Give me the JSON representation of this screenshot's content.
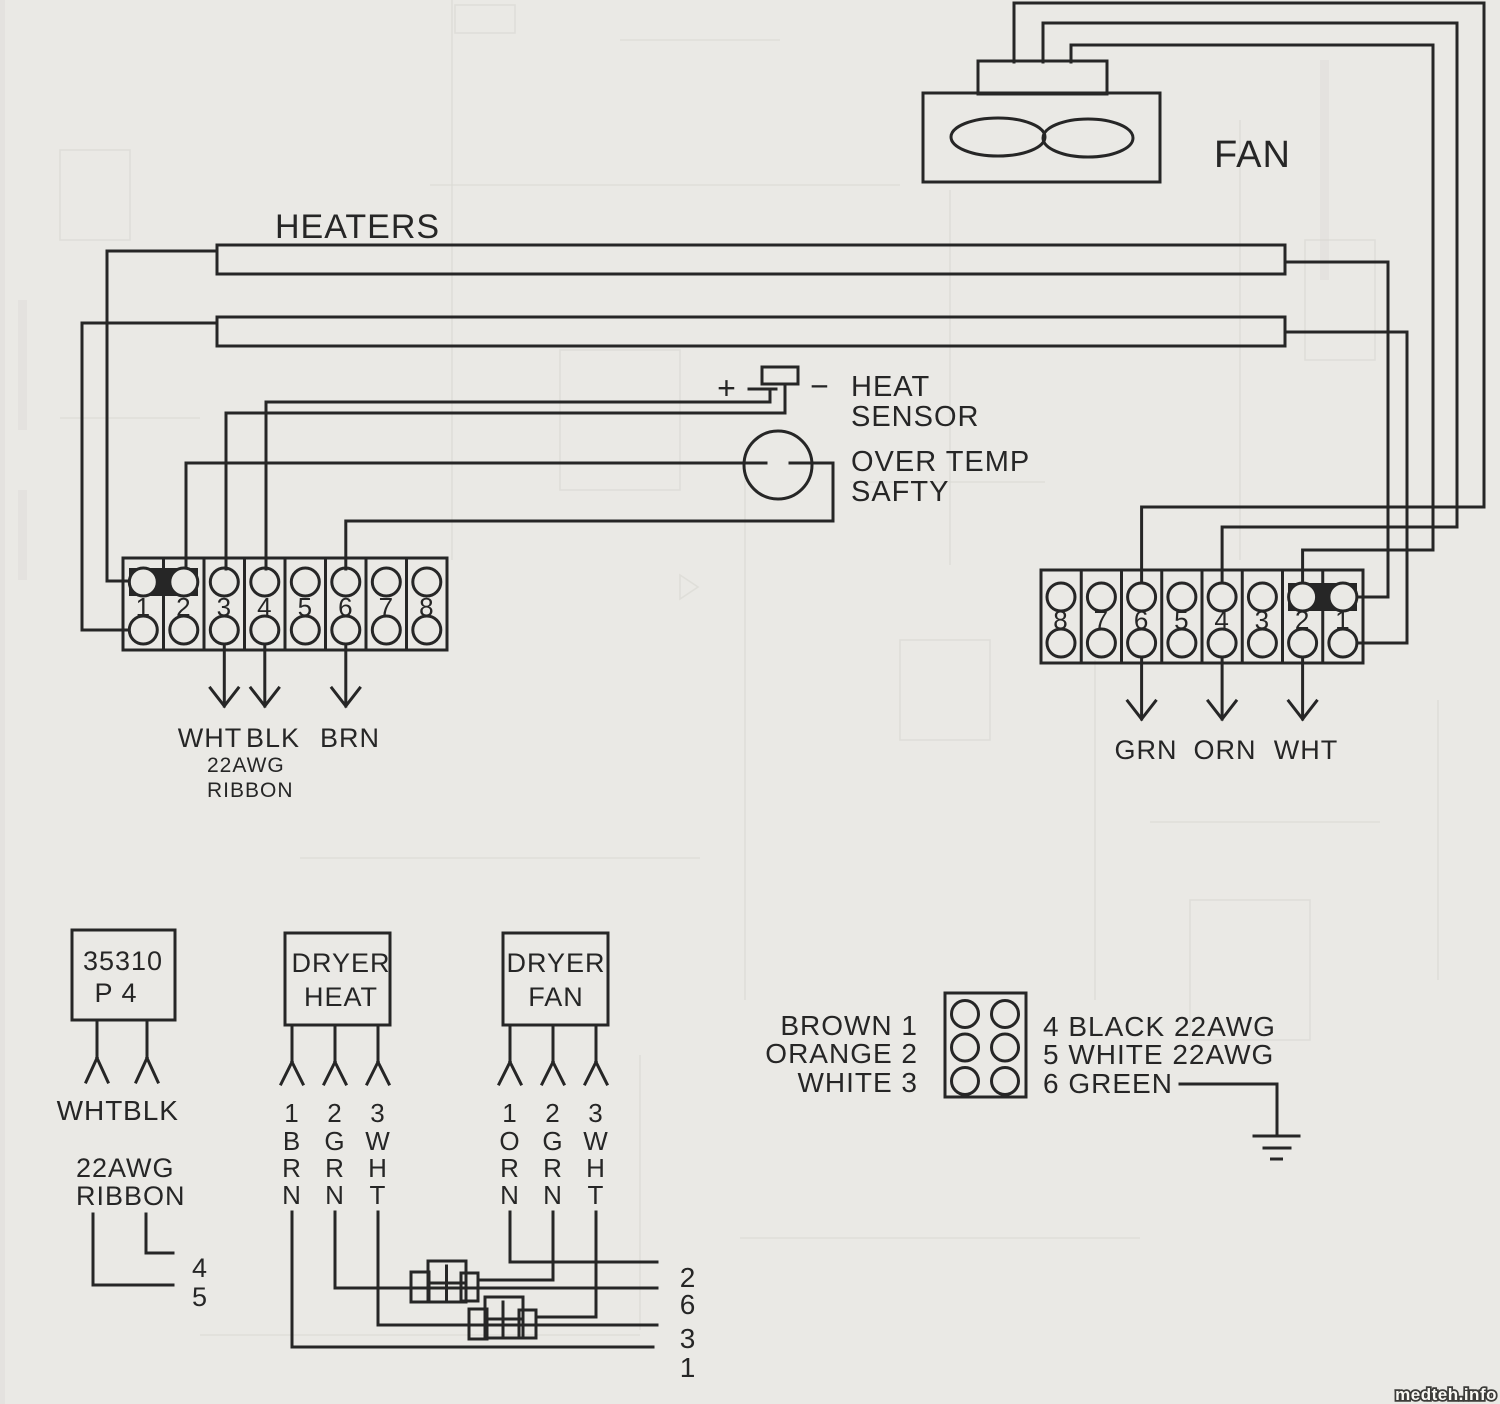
{
  "palette": {
    "paper": "#eae9e5",
    "ink": "#262626",
    "ghost_line": "#d9d8d3",
    "watermark_text": "#faf9f4",
    "watermark_outline": "#3c3c39"
  },
  "fan": {
    "label": "FAN"
  },
  "heaters": {
    "label": "HEATERS"
  },
  "heat_sensor": {
    "plus": "+",
    "minus": "−",
    "label": [
      "HEAT",
      "SENSOR"
    ]
  },
  "over_temp": {
    "label": [
      "OVER TEMP",
      "SAFTY"
    ]
  },
  "left_block": {
    "cells": [
      "1",
      "2",
      "3",
      "4",
      "5",
      "6",
      "7",
      "8"
    ],
    "wire_labels": [
      "WHT",
      "BLK",
      "BRN"
    ],
    "wire_note": [
      "22AWG",
      "RIBBON"
    ]
  },
  "right_block": {
    "cells": [
      "8",
      "7",
      "6",
      "5",
      "4",
      "3",
      "2",
      "1"
    ],
    "wire_labels": [
      "GRN",
      "ORN",
      "WHT"
    ]
  },
  "plug_35310": {
    "label": [
      "35310",
      "P 4"
    ],
    "lead_labels": [
      "WHT",
      "BLK"
    ],
    "note": [
      "22AWG",
      "RIBBON"
    ],
    "pin_numbers": [
      "4",
      "5"
    ]
  },
  "dryer_heat": {
    "label": [
      "DRYER",
      "HEAT"
    ],
    "leads": [
      [
        "1",
        "B",
        "R",
        "N"
      ],
      [
        "2",
        "G",
        "R",
        "N"
      ],
      [
        "3",
        "W",
        "H",
        "T"
      ]
    ]
  },
  "dryer_fan": {
    "label": [
      "DRYER",
      "FAN"
    ],
    "leads": [
      [
        "1",
        "O",
        "R",
        "N"
      ],
      [
        "2",
        "G",
        "R",
        "N"
      ],
      [
        "3",
        "W",
        "H",
        "T"
      ]
    ]
  },
  "bottom_pins": [
    "2",
    "6",
    "3",
    "1"
  ],
  "harness_connector": {
    "left_pins": [
      "BROWN 1",
      "ORANGE 2",
      "WHITE 3"
    ],
    "right_pins": [
      "4 BLACK 22AWG",
      "5 WHITE 22AWG",
      "6 GREEN"
    ]
  },
  "watermark": "medteh.info"
}
